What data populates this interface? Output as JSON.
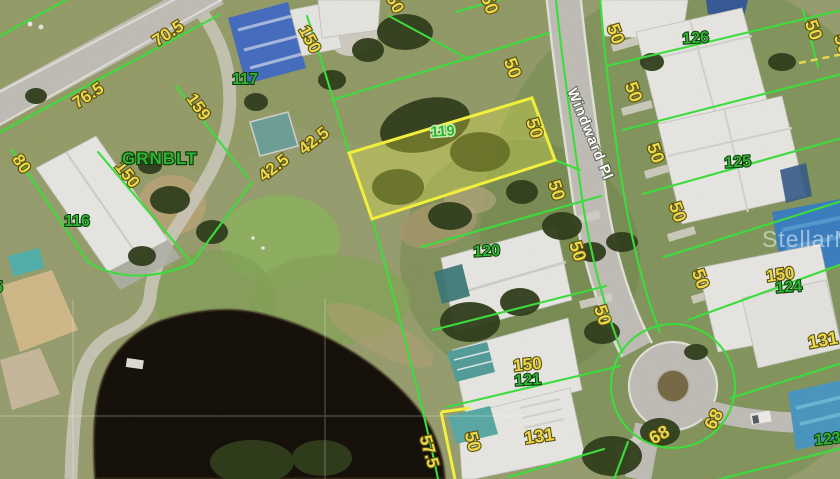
{
  "map": {
    "street_label": "Windward Pl",
    "greenbelt_label": "GRNBLT",
    "watermark": "StellarMLS",
    "colors": {
      "parcel_line": "#3ddc3d",
      "highlight_line": "#f2ef3c",
      "dimension_text": "#ecd84c",
      "lot_number_text": "#2fb52f",
      "street_text": "#fdfdfa"
    },
    "lot_numbers": [
      {
        "text": "117",
        "x": 245,
        "y": 84,
        "rot": 0,
        "size": 16
      },
      {
        "text": "116",
        "x": 77,
        "y": 226,
        "rot": 0,
        "size": 16
      },
      {
        "text": "119",
        "x": 443,
        "y": 136,
        "rot": -4,
        "size": 15,
        "halo": true
      },
      {
        "text": "120",
        "x": 487,
        "y": 256,
        "rot": -3,
        "size": 16
      },
      {
        "text": "121",
        "x": 528,
        "y": 385,
        "rot": -4,
        "size": 16
      },
      {
        "text": "126",
        "x": 696,
        "y": 43,
        "rot": -4,
        "size": 16
      },
      {
        "text": "125",
        "x": 738,
        "y": 167,
        "rot": -4,
        "size": 16
      },
      {
        "text": "124",
        "x": 789,
        "y": 292,
        "rot": -4,
        "size": 16
      },
      {
        "text": "123",
        "x": 828,
        "y": 444,
        "rot": -6,
        "size": 16
      },
      {
        "text": "115",
        "x": -10,
        "y": 292,
        "rot": 0,
        "size": 16
      }
    ],
    "dimension_labels": [
      {
        "text": "70.5",
        "x": 171,
        "y": 38,
        "rot": -33,
        "size": 17
      },
      {
        "text": "76.5",
        "x": 91,
        "y": 100,
        "rot": -33,
        "size": 17
      },
      {
        "text": "80",
        "x": 17,
        "y": 167,
        "rot": 55,
        "size": 17
      },
      {
        "text": "159",
        "x": 194,
        "y": 110,
        "rot": 55,
        "size": 17
      },
      {
        "text": "150",
        "x": 123,
        "y": 178,
        "rot": 52,
        "size": 17
      },
      {
        "text": "150",
        "x": 305,
        "y": 42,
        "rot": 62,
        "size": 17
      },
      {
        "text": "150",
        "x": 388,
        "y": 2,
        "rot": 62,
        "size": 17
      },
      {
        "text": "42.5",
        "x": 317,
        "y": 145,
        "rot": -38,
        "size": 17
      },
      {
        "text": "42.5",
        "x": 277,
        "y": 172,
        "rot": -38,
        "size": 17
      },
      {
        "text": "50",
        "x": 484,
        "y": 6,
        "rot": 70,
        "size": 18
      },
      {
        "text": "50",
        "x": 507,
        "y": 70,
        "rot": 70,
        "size": 18
      },
      {
        "text": "50",
        "x": 529,
        "y": 130,
        "rot": 72,
        "size": 18
      },
      {
        "text": "50",
        "x": 551,
        "y": 192,
        "rot": 72,
        "size": 18
      },
      {
        "text": "50",
        "x": 572,
        "y": 253,
        "rot": 72,
        "size": 18
      },
      {
        "text": "50",
        "x": 597,
        "y": 317,
        "rot": 72,
        "size": 18
      },
      {
        "text": "50",
        "x": 610,
        "y": 36,
        "rot": 70,
        "size": 18
      },
      {
        "text": "50",
        "x": 628,
        "y": 94,
        "rot": 70,
        "size": 18
      },
      {
        "text": "50",
        "x": 650,
        "y": 155,
        "rot": 70,
        "size": 18
      },
      {
        "text": "50",
        "x": 672,
        "y": 214,
        "rot": 70,
        "size": 18
      },
      {
        "text": "50",
        "x": 695,
        "y": 281,
        "rot": 70,
        "size": 18
      },
      {
        "text": "50",
        "x": 808,
        "y": 32,
        "rot": 70,
        "size": 18
      },
      {
        "text": "50",
        "x": 837,
        "y": 46,
        "rot": 70,
        "size": 18
      },
      {
        "text": "150",
        "x": 781,
        "y": 280,
        "rot": -8,
        "size": 17
      },
      {
        "text": "150",
        "x": 528,
        "y": 370,
        "rot": -6,
        "size": 17
      },
      {
        "text": "131",
        "x": 540,
        "y": 442,
        "rot": -8,
        "size": 18
      },
      {
        "text": "131",
        "x": 824,
        "y": 346,
        "rot": -10,
        "size": 18
      },
      {
        "text": "57.5",
        "x": 424,
        "y": 453,
        "rot": 74,
        "size": 17
      },
      {
        "text": "50",
        "x": 467,
        "y": 443,
        "rot": 76,
        "size": 18
      },
      {
        "text": "68",
        "x": 662,
        "y": 440,
        "rot": -28,
        "size": 18
      },
      {
        "text": "68",
        "x": 719,
        "y": 422,
        "rot": -62,
        "size": 18
      }
    ]
  }
}
